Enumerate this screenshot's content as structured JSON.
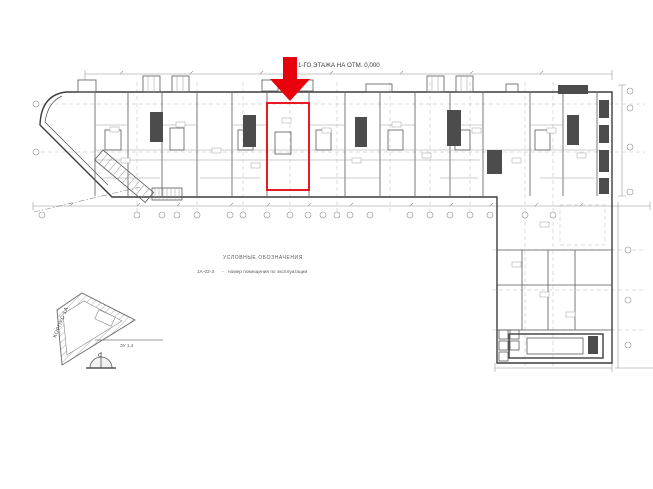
{
  "drawing": {
    "title_visible": "1-ГО ЭТАЖА НА ОТМ. 0,000",
    "legend": {
      "heading": "УСЛОВНЫЕ ОБОЗНАЧЕНИЯ",
      "items": [
        {
          "code": "1А-02-3",
          "separator": "-",
          "description": "номер помещения по эксплуатации"
        }
      ]
    },
    "site_symbol": {
      "building_label": "КОРПУС 1А",
      "plot_label": "ЗУ 1,4",
      "north_label": "С"
    },
    "highlight": {
      "color": "#e8000d"
    },
    "colors": {
      "line_dark": "#3d3d3d",
      "line_light": "#9a9a9a",
      "red": "#e8000d",
      "background": "#ffffff"
    }
  }
}
